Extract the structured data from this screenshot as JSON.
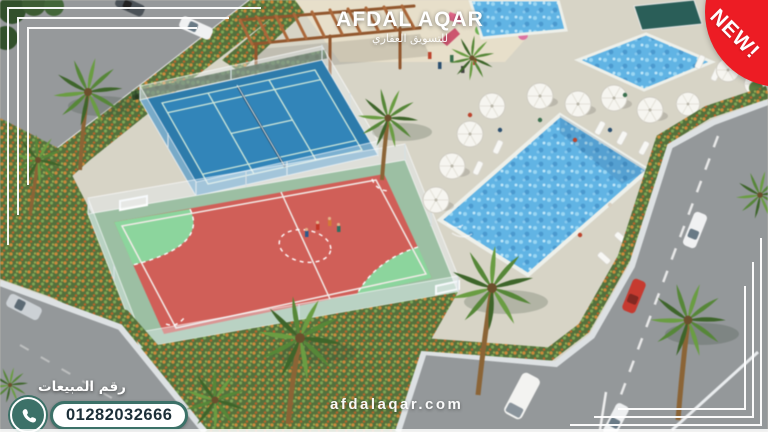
{
  "brand": {
    "name": "AFDAL AQAR",
    "tagline": "للتسويق العقاري"
  },
  "badge": {
    "label": "NEW!",
    "color": "#ed1c24"
  },
  "sales": {
    "label": "رقم المبيعات",
    "phone": "01282032666",
    "accent": "#3c7168"
  },
  "watermark": {
    "text": "afdalaqar.com"
  },
  "scene": {
    "type": "aerial-3d-render",
    "features": [
      "tennis-court",
      "football-court",
      "swimming-pool",
      "kids-pool",
      "pool-umbrellas",
      "sun-loungers",
      "pergola",
      "playground",
      "palm-trees",
      "streets",
      "cars"
    ],
    "colors": {
      "tennis_court": "#2f7aa9",
      "football_court": "#cd6059",
      "goal_zone": "#8ed49e",
      "pool_water": "#64b3e2",
      "deck": "#d7d4c7",
      "road": "#94989a",
      "shrubs": "#55713e",
      "wall": "#dde1e3"
    }
  }
}
